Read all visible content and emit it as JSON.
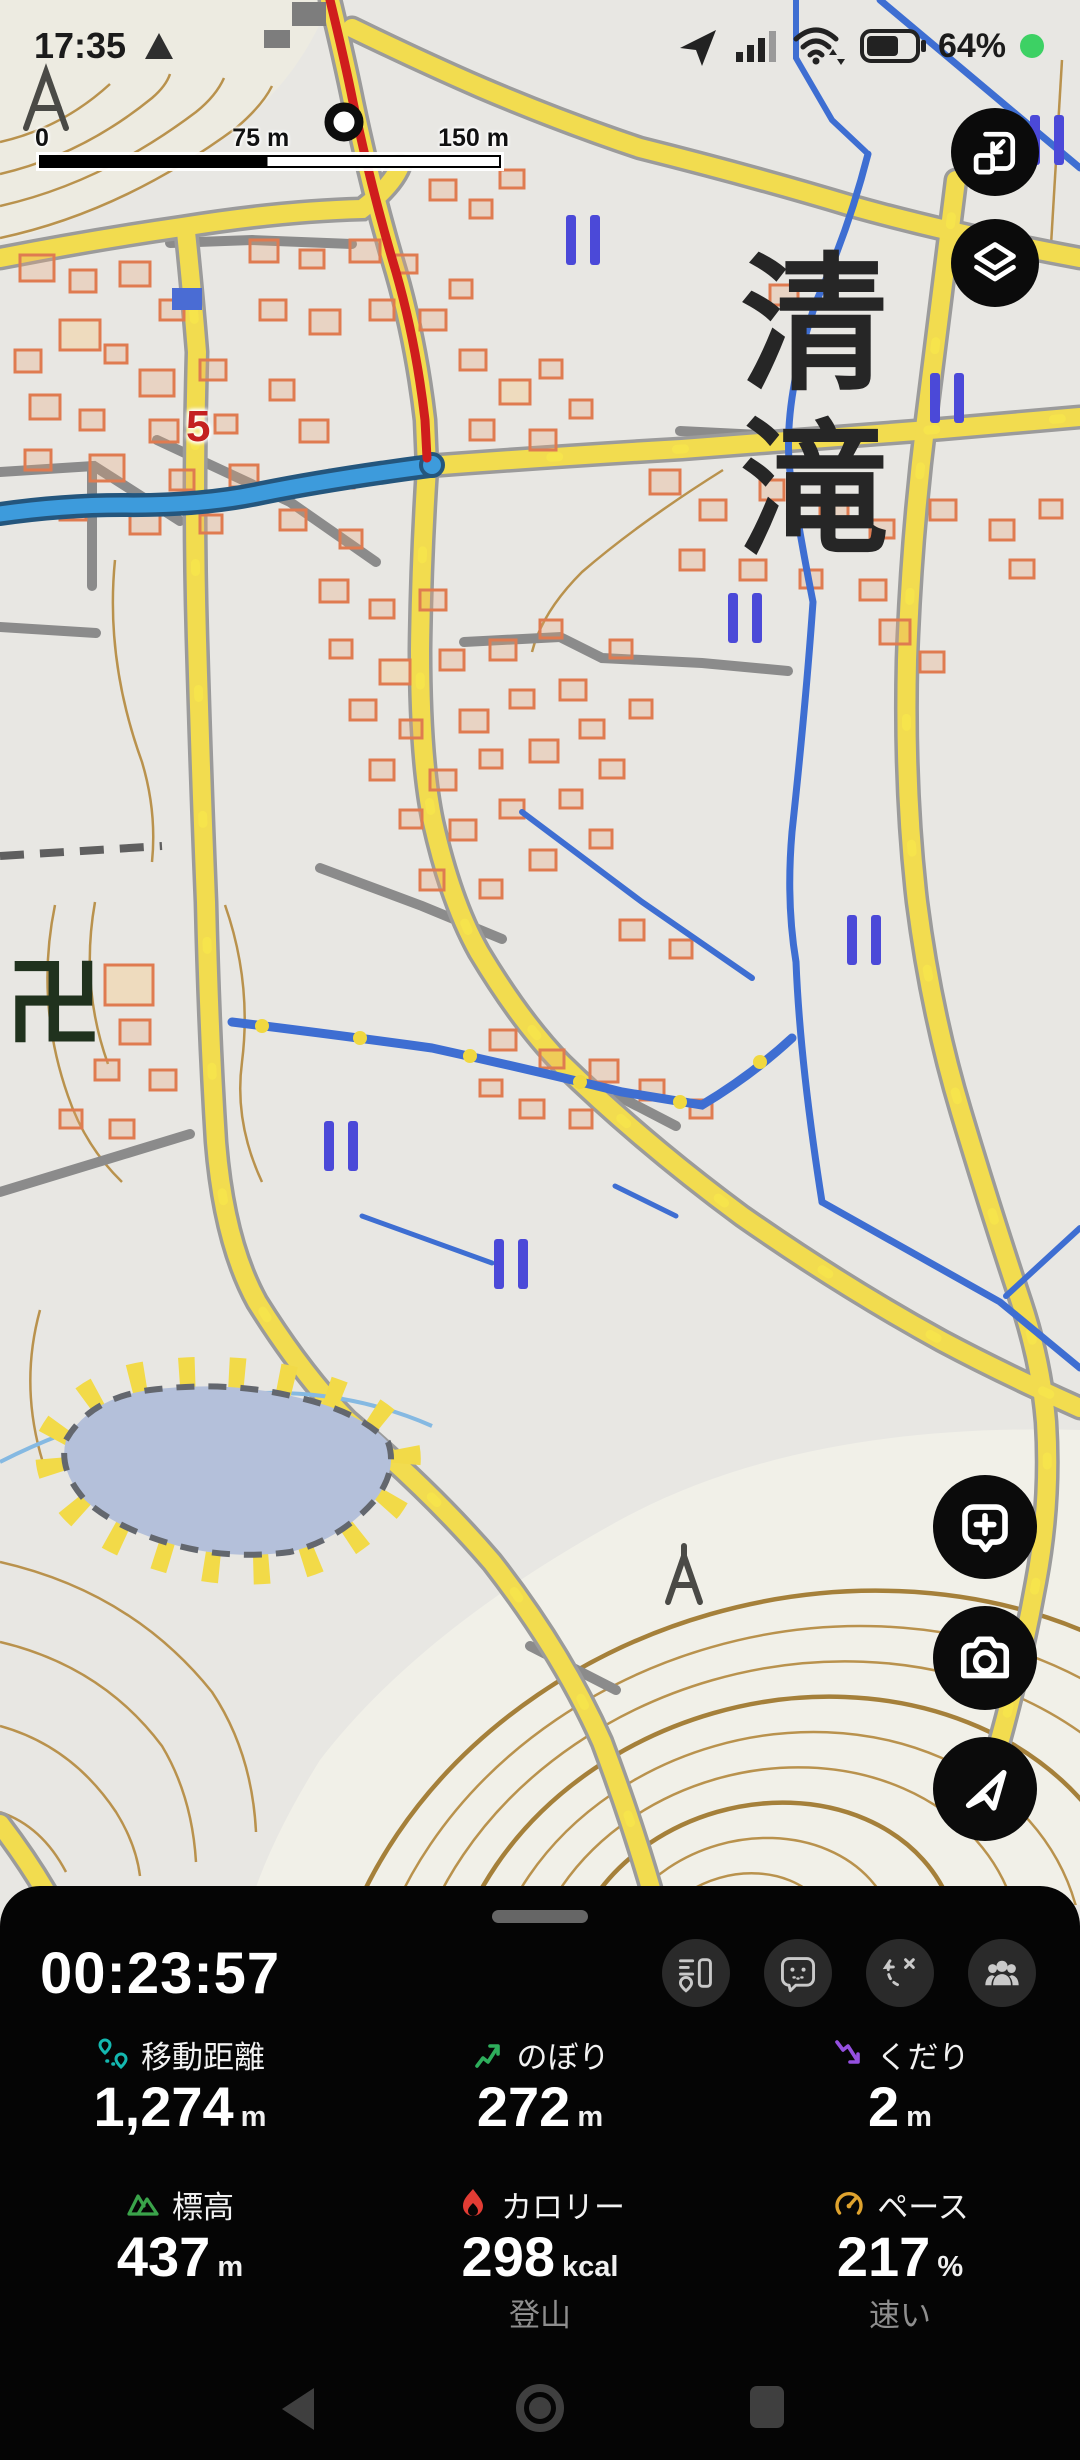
{
  "status_bar": {
    "time": "17:35",
    "battery_percent": "64%"
  },
  "map": {
    "scale_labels": {
      "start": "0",
      "mid": "75 m",
      "end": "150 m"
    },
    "place_name": "清滝",
    "route_number": "5",
    "temple_symbol": "卍"
  },
  "panel": {
    "timer": "00:23:57",
    "stats": [
      {
        "label": "移動距離",
        "value": "1,274",
        "unit": "m"
      },
      {
        "label": "のぼり",
        "value": "272",
        "unit": "m"
      },
      {
        "label": "くだり",
        "value": "2",
        "unit": "m"
      },
      {
        "label": "標高",
        "value": "437",
        "unit": "m"
      },
      {
        "label": "カロリー",
        "value": "298",
        "unit": "kcal"
      },
      {
        "label": "ペース",
        "value": "217",
        "unit": "%"
      }
    ],
    "activity_type": "登山",
    "pace_rating": "速い"
  }
}
